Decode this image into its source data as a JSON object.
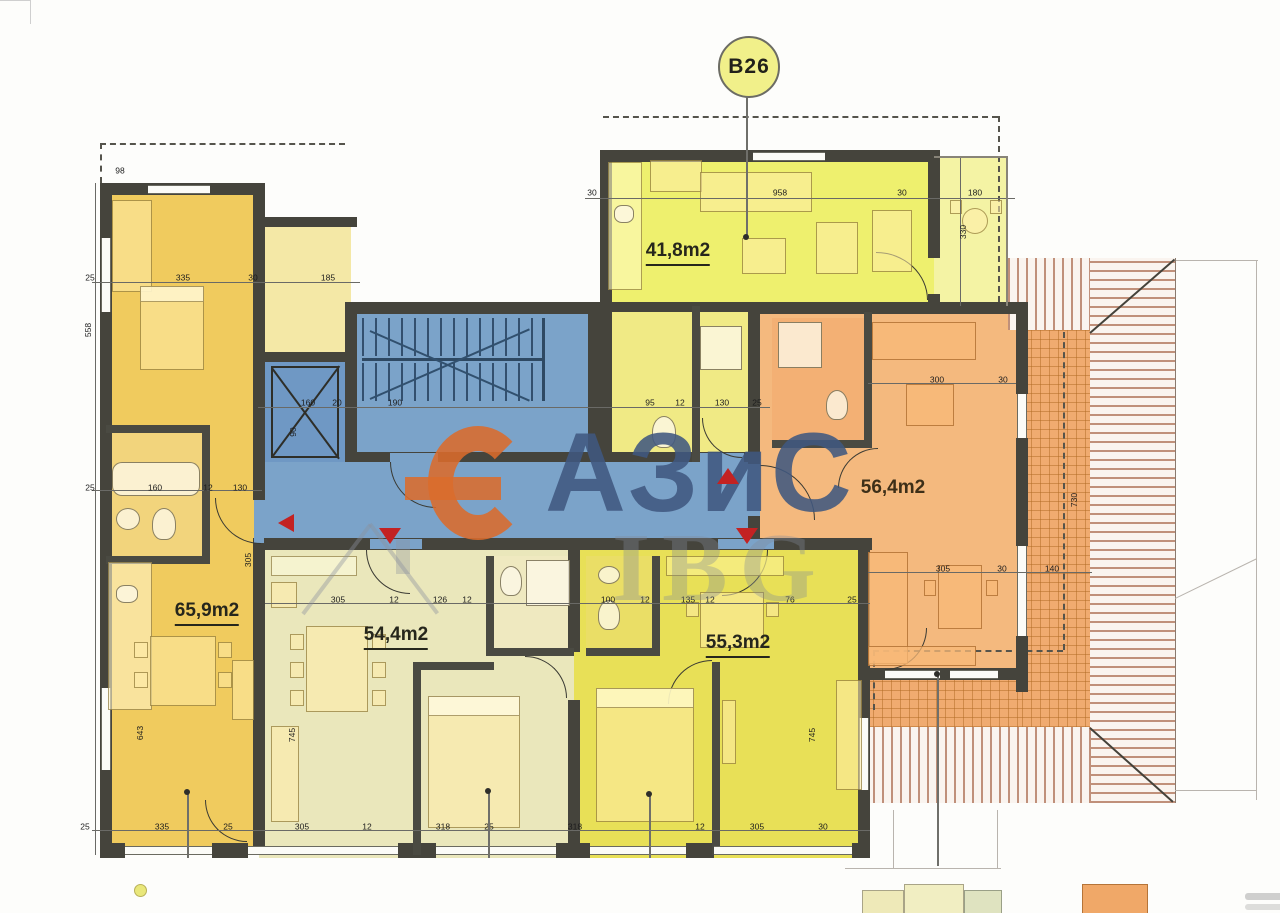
{
  "badge": {
    "label": "B26"
  },
  "watermark": {
    "main": "АЗиС",
    "secondary": "IBG"
  },
  "apartments": [
    {
      "name": "top-yellow-studio",
      "area_label": "41,8m2"
    },
    {
      "name": "orange-apartment",
      "area_label": "56,4m2"
    },
    {
      "name": "left-gold-apartment",
      "area_label": "65,9m2"
    },
    {
      "name": "bottom-pale-apartment",
      "area_label": "54,4m2"
    },
    {
      "name": "bottom-yellow-apartment",
      "area_label": "55,3m2"
    }
  ],
  "dimension_labels": [
    {
      "t": "30",
      "x": 592,
      "y": 193
    },
    {
      "t": "958",
      "x": 780,
      "y": 193
    },
    {
      "t": "30",
      "x": 902,
      "y": 193
    },
    {
      "t": "180",
      "x": 975,
      "y": 193
    },
    {
      "t": "98",
      "x": 120,
      "y": 171
    },
    {
      "t": "25",
      "x": 90,
      "y": 278
    },
    {
      "t": "335",
      "x": 183,
      "y": 278
    },
    {
      "t": "30",
      "x": 253,
      "y": 278
    },
    {
      "t": "185",
      "x": 328,
      "y": 278
    },
    {
      "t": "160",
      "x": 308,
      "y": 403
    },
    {
      "t": "20",
      "x": 337,
      "y": 403
    },
    {
      "t": "190",
      "x": 395,
      "y": 403
    },
    {
      "t": "95",
      "x": 650,
      "y": 403
    },
    {
      "t": "12",
      "x": 680,
      "y": 403
    },
    {
      "t": "130",
      "x": 722,
      "y": 403
    },
    {
      "t": "25",
      "x": 757,
      "y": 403
    },
    {
      "t": "25",
      "x": 90,
      "y": 488
    },
    {
      "t": "160",
      "x": 155,
      "y": 488
    },
    {
      "t": "12",
      "x": 208,
      "y": 488
    },
    {
      "t": "130",
      "x": 240,
      "y": 488
    },
    {
      "t": "300",
      "x": 937,
      "y": 380
    },
    {
      "t": "30",
      "x": 1003,
      "y": 380
    },
    {
      "t": "305",
      "x": 943,
      "y": 569
    },
    {
      "t": "30",
      "x": 1002,
      "y": 569
    },
    {
      "t": "140",
      "x": 1052,
      "y": 569
    },
    {
      "t": "305",
      "x": 338,
      "y": 600
    },
    {
      "t": "12",
      "x": 394,
      "y": 600
    },
    {
      "t": "126",
      "x": 440,
      "y": 600
    },
    {
      "t": "12",
      "x": 467,
      "y": 600
    },
    {
      "t": "100",
      "x": 608,
      "y": 600
    },
    {
      "t": "12",
      "x": 645,
      "y": 600
    },
    {
      "t": "135",
      "x": 688,
      "y": 600
    },
    {
      "t": "12",
      "x": 710,
      "y": 600
    },
    {
      "t": "76",
      "x": 790,
      "y": 600
    },
    {
      "t": "25",
      "x": 852,
      "y": 600
    },
    {
      "t": "25",
      "x": 85,
      "y": 827
    },
    {
      "t": "335",
      "x": 162,
      "y": 827
    },
    {
      "t": "25",
      "x": 228,
      "y": 827
    },
    {
      "t": "305",
      "x": 302,
      "y": 827
    },
    {
      "t": "12",
      "x": 367,
      "y": 827
    },
    {
      "t": "318",
      "x": 443,
      "y": 827
    },
    {
      "t": "25",
      "x": 489,
      "y": 827
    },
    {
      "t": "318",
      "x": 575,
      "y": 827
    },
    {
      "t": "12",
      "x": 700,
      "y": 827
    },
    {
      "t": "305",
      "x": 757,
      "y": 827
    },
    {
      "t": "30",
      "x": 823,
      "y": 827
    },
    {
      "t": "330",
      "x": 963,
      "y": 232,
      "r": 1
    },
    {
      "t": "730",
      "x": 1074,
      "y": 500,
      "r": 1
    },
    {
      "t": "745",
      "x": 812,
      "y": 735,
      "r": 1
    },
    {
      "t": "745",
      "x": 292,
      "y": 735,
      "r": 1
    },
    {
      "t": "643",
      "x": 140,
      "y": 733,
      "r": 1
    },
    {
      "t": "90",
      "x": 293,
      "y": 432,
      "r": 1
    },
    {
      "t": "558",
      "x": 88,
      "y": 330,
      "r": 1
    },
    {
      "t": "305",
      "x": 248,
      "y": 560,
      "r": 1
    }
  ]
}
